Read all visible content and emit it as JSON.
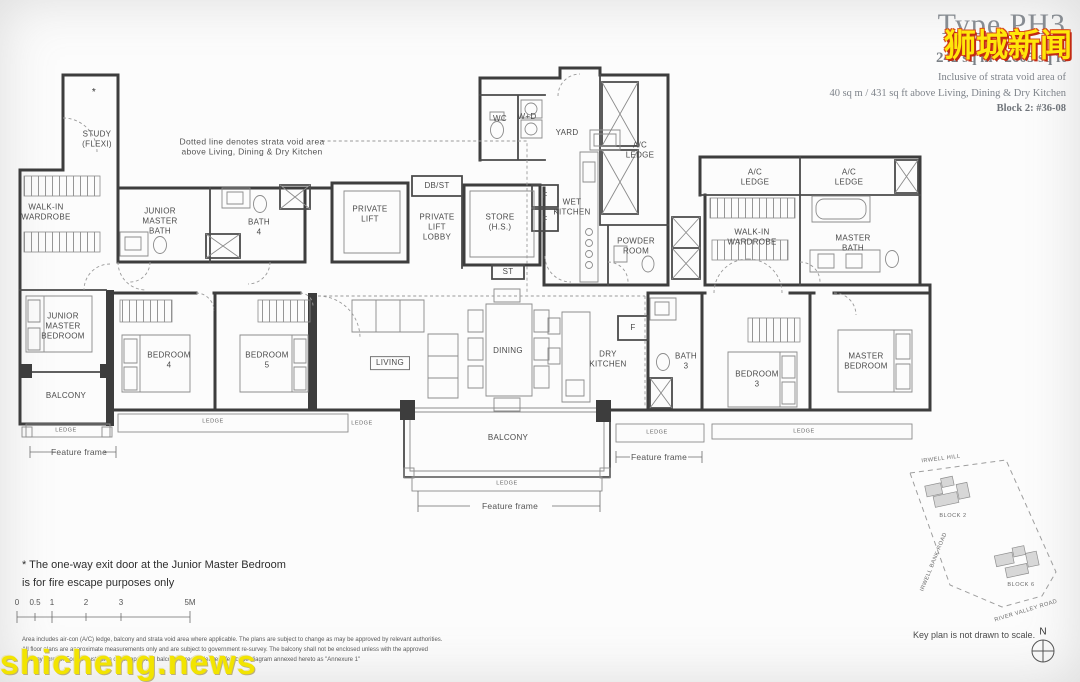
{
  "watermarks": {
    "top_right": "狮城新闻",
    "bottom_left": "shicheng.news"
  },
  "title_block": {
    "type": "Type PH3",
    "area": "242 sq m / 2605 sq ft",
    "inclusive_1": "Inclusive of strata void area of",
    "inclusive_2": "40 sq m / 431 sq ft above Living, Dining & Dry Kitchen",
    "unit": "Block 2: #36-08"
  },
  "strata_note": "Dotted line denotes strata void area\nabove Living, Dining & Dry Kitchen",
  "labels": {
    "study": "STUDY\n(FLEXI)",
    "asterisk": "*",
    "walk_in_wardrobe": "WALK-IN\nWARDROBE",
    "junior_master_bath": "JUNIOR\nMASTER\nBATH",
    "bath_4": "BATH\n4",
    "private_lift": "PRIVATE\nLIFT",
    "db_st": "DB/ST",
    "private_lift_lobby": "PRIVATE\nLIFT\nLOBBY",
    "store": "STORE\n(H.S.)",
    "st": "ST",
    "wc": "WC",
    "w_d": "W+D",
    "yard": "YARD",
    "ac_ledge": "A/C\nLEDGE",
    "wet_kitchen": "WET\nKITCHEN",
    "f": "F",
    "powder_room": "POWDER\nROOM",
    "master_bath": "MASTER\nBATH",
    "junior_master_bedroom": "JUNIOR\nMASTER\nBEDROOM",
    "bedroom_4": "BEDROOM\n4",
    "bedroom_5": "BEDROOM\n5",
    "living": "LIVING",
    "dining": "DINING",
    "dry_kitchen": "DRY\nKITCHEN",
    "bath_3": "BATH\n3",
    "bedroom_3": "BEDROOM\n3",
    "master_bedroom": "MASTER\nBEDROOM",
    "balcony": "BALCONY",
    "ledge": "LEDGE",
    "feature_frame": "Feature frame"
  },
  "footnote": "* The one-way exit door at the Junior Master Bedroom\nis for fire escape purposes only",
  "scale_bar": {
    "ticks": [
      "0",
      "0.5",
      "1",
      "2",
      "3",
      "5M"
    ]
  },
  "disclaimer": "Area includes air-con (A/C) ledge, balcony and strata void area where applicable. The plans are subject to change as may be approved by relevant authorities.\nAll floor plans are approximate measurements only and are subject to government re-survey. The balcony shall not be enclosed unless with the approved\nbalcony screen. For an illustration of the approved balcony screen, please refer to the diagram annexed hereto as \"Annexure 1\"",
  "key_plan": {
    "road_top": "IRWELL HILL",
    "road_left": "IRWELL BANK ROAD",
    "road_bottom": "RIVER VALLEY ROAD",
    "block_2": "BLOCK 2",
    "block_6": "BLOCK 6",
    "note": "Key plan is not drawn to scale.",
    "north": "N"
  }
}
